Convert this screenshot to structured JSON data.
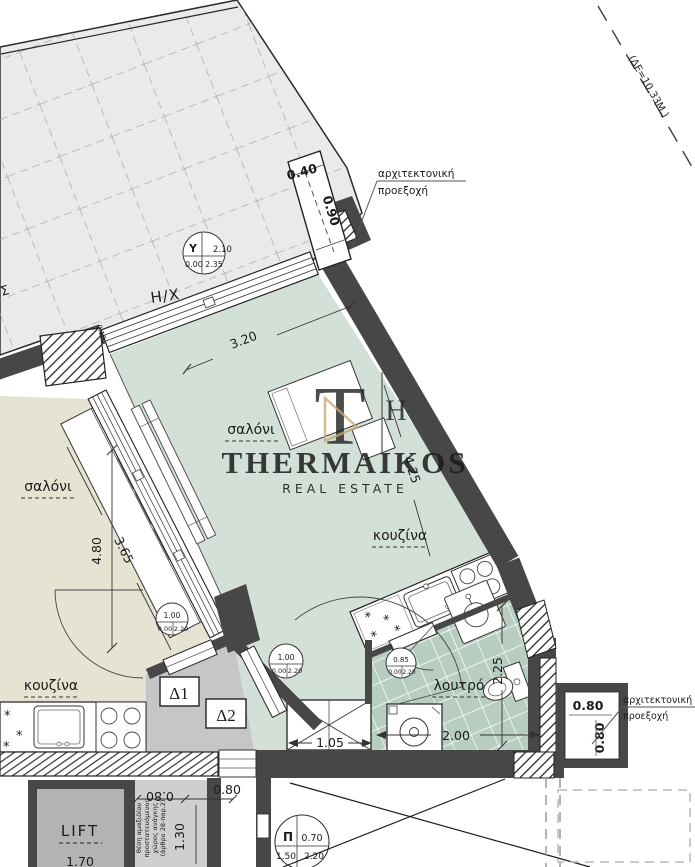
{
  "colors": {
    "wall": "#474747",
    "studio_floor": "#d2e0d8",
    "bath_floor": "#b7cdc0",
    "left_floor": "#e7e3d3",
    "hall_floor": "#c6c6c6",
    "terrace": "#eaeaea",
    "logo_tan": "#c9a876",
    "watermark_gray": "#8f8f8f"
  },
  "watermark": {
    "brand": "THERMAIKOS",
    "tagline": "REAL ESTATE",
    "monogram_t": "T",
    "monogram_h": "H"
  },
  "site": {
    "boundary_label": "(ΔΕ=10.33Μ.)",
    "edge_partial": "Σ"
  },
  "terrace": {
    "label": "Η/Χ",
    "symbol": {
      "key": "Υ",
      "top": "2.10",
      "sill": "0.00",
      "height": "2.35"
    }
  },
  "annotations": {
    "top_projection": {
      "line1": "αρχιτεκτονική",
      "line2": "προεξοχή",
      "width": "0.40",
      "depth": "0.90"
    },
    "right_projection": {
      "line1": "αρχιτεκτονική",
      "line2": "προεξοχή",
      "width": "0.80",
      "depth": "0.80"
    }
  },
  "studio": {
    "living_label": "σαλόνι",
    "kitchen_label": "κουζίνα",
    "bath_label": "λουτρό",
    "dims": {
      "width": "3.20",
      "length": "4.25",
      "wall": "0.10",
      "closet": "1.05",
      "bath_width": "2.00",
      "bath_depth": "2.25"
    },
    "door_tag": "Δ2",
    "door": {
      "width": "1.00",
      "sill": "0.00",
      "height": "2.20"
    },
    "bath_door": {
      "width": "0.85",
      "sill": "0.00",
      "height": "2.20"
    }
  },
  "apartment_left": {
    "living_label": "σαλόνι",
    "kitchen_label": "κουζίνα",
    "dims": {
      "diag": "3.65",
      "depth": "4.80"
    },
    "door_tag": "Δ1",
    "door": {
      "width": "1.00",
      "sill": "0.00",
      "height": "2.20"
    }
  },
  "core": {
    "lift_label": "LIFT",
    "lift_width": "1.70",
    "shaft_dims": {
      "w1": "0.80",
      "w2": "0.80",
      "h": "1.30"
    },
    "shaft_note": [
      "θέση αμαξιδίου",
      "προστατευόμενος",
      "χώρος ανάγκης",
      "(άρθρο 28-παρ.2)"
    ],
    "exit_symbol": {
      "key": "Π",
      "top": "0.70",
      "sill": "1.50",
      "height": "2.20"
    }
  }
}
